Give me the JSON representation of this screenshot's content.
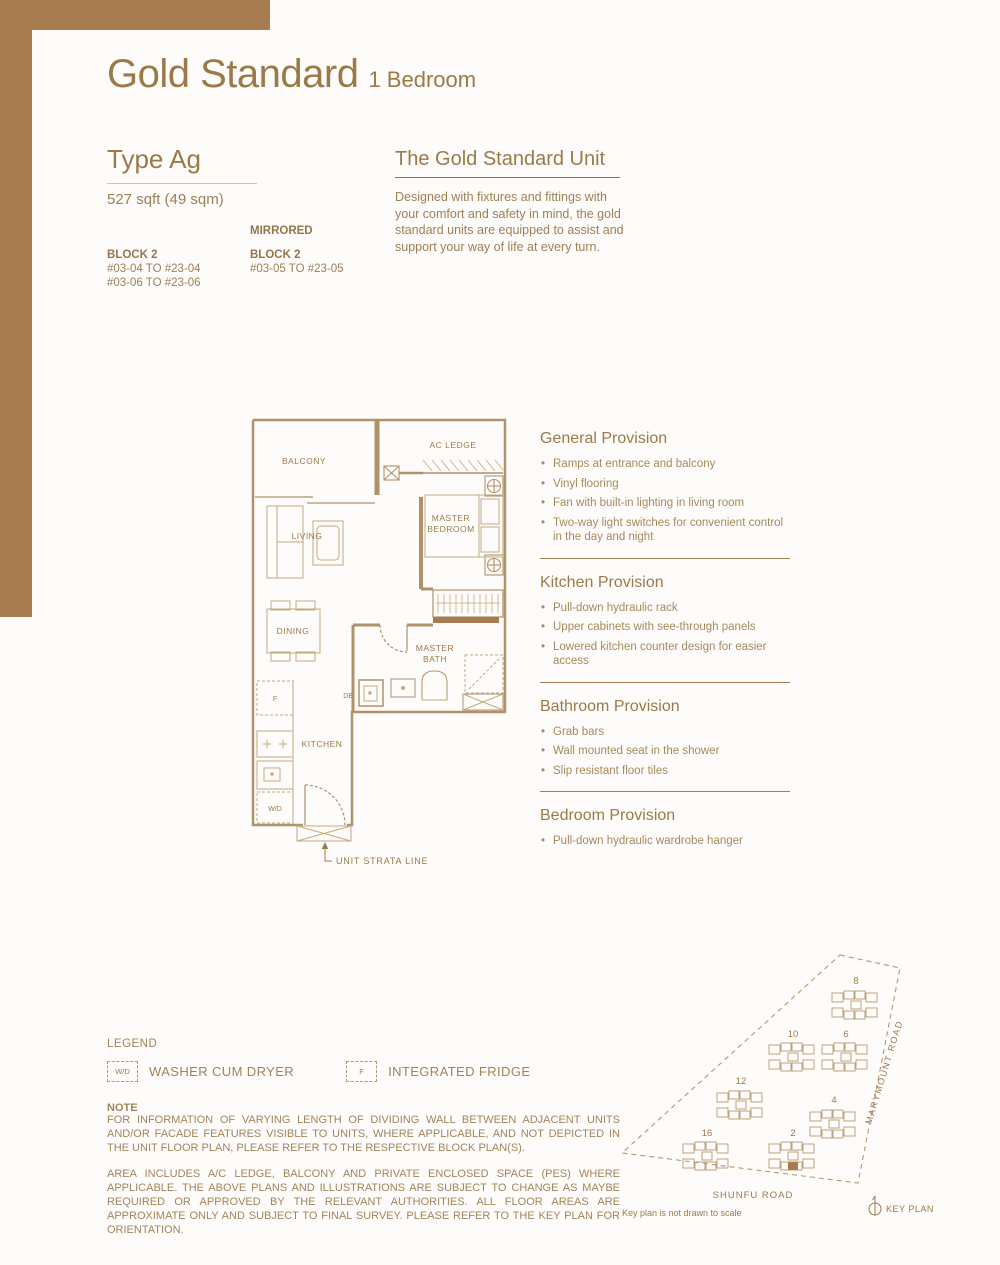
{
  "header": {
    "title": "Gold Standard",
    "subtitle": "1 Bedroom"
  },
  "type_info": {
    "heading": "Type Ag",
    "area": "527 sqft (49 sqm)",
    "primary": {
      "block": "BLOCK 2",
      "units": [
        "#03-04 TO #23-04",
        "#03-06 TO #23-06"
      ]
    },
    "mirrored": {
      "label": "MIRRORED",
      "block": "BLOCK 2",
      "units": [
        "#03-05 TO #23-05"
      ]
    }
  },
  "unit_info": {
    "heading": "The Gold Standard Unit",
    "description": "Designed with fixtures and fittings with your comfort and safety in mind, the gold standard units are equipped to assist and support your way of life at every turn."
  },
  "floorplan": {
    "labels": {
      "balcony": "BALCONY",
      "ac_ledge": "AC LEDGE",
      "living": "LIVING",
      "master_1": "MASTER",
      "master_2": "BEDROOM",
      "dining": "DINING",
      "bath_1": "MASTER",
      "bath_2": "BATH",
      "kitchen": "KITCHEN",
      "db": "DB",
      "fridge": "F",
      "washer": "W/D",
      "strata": "UNIT STRATA LINE"
    }
  },
  "provisions": [
    {
      "heading": "General Provision",
      "items": [
        "Ramps at entrance and balcony",
        "Vinyl flooring",
        "Fan with built-in lighting in living room",
        "Two-way light switches for convenient control in the day and night"
      ]
    },
    {
      "heading": "Kitchen Provision",
      "items": [
        "Pull-down hydraulic rack",
        "Upper cabinets with see-through panels",
        "Lowered kitchen counter design for easier access"
      ]
    },
    {
      "heading": "Bathroom Provision",
      "items": [
        "Grab bars",
        "Wall mounted seat in the shower",
        "Slip resistant floor tiles"
      ]
    },
    {
      "heading": "Bedroom Provision",
      "items": [
        "Pull-down hydraulic wardrobe hanger"
      ]
    }
  ],
  "legend": {
    "heading": "LEGEND",
    "items": [
      {
        "symbol": "W/D",
        "label": "WASHER CUM DRYER"
      },
      {
        "symbol": "F",
        "label": "INTEGRATED FRIDGE"
      }
    ]
  },
  "note": {
    "heading": "NOTE",
    "paragraphs": [
      "FOR INFORMATION OF VARYING LENGTH OF DIVIDING WALL BETWEEN ADJACENT UNITS AND/OR FACADE FEATURES VISIBLE TO UNITS, WHERE APPLICABLE, AND NOT DEPICTED IN THE UNIT FLOOR PLAN, PLEASE REFER TO THE RESPECTIVE BLOCK PLAN(S).",
      "AREA INCLUDES A/C LEDGE, BALCONY AND PRIVATE ENCLOSED SPACE (PES) WHERE APPLICABLE. THE ABOVE PLANS AND ILLUSTRATIONS ARE SUBJECT TO CHANGE AS MAYBE REQUIRED OR APPROVED BY THE RELEVANT AUTHORITIES. ALL FLOOR AREAS ARE APPROXIMATE ONLY AND SUBJECT TO FINAL SURVEY. PLEASE REFER TO THE KEY PLAN FOR ORIENTATION."
    ]
  },
  "keyplan": {
    "blocks": [
      "8",
      "10",
      "6",
      "12",
      "4",
      "16",
      "2"
    ],
    "roads": {
      "right": "MARYMOUNT ROAD",
      "bottom": "SHUNFU ROAD"
    },
    "disclaimer": "Key plan is not drawn to scale",
    "label": "KEY PLAN"
  },
  "colors": {
    "brown": "#a87c50",
    "gold": "#9b7a48",
    "body_text": "#9d8054",
    "plan_wall": "#b0926a"
  }
}
